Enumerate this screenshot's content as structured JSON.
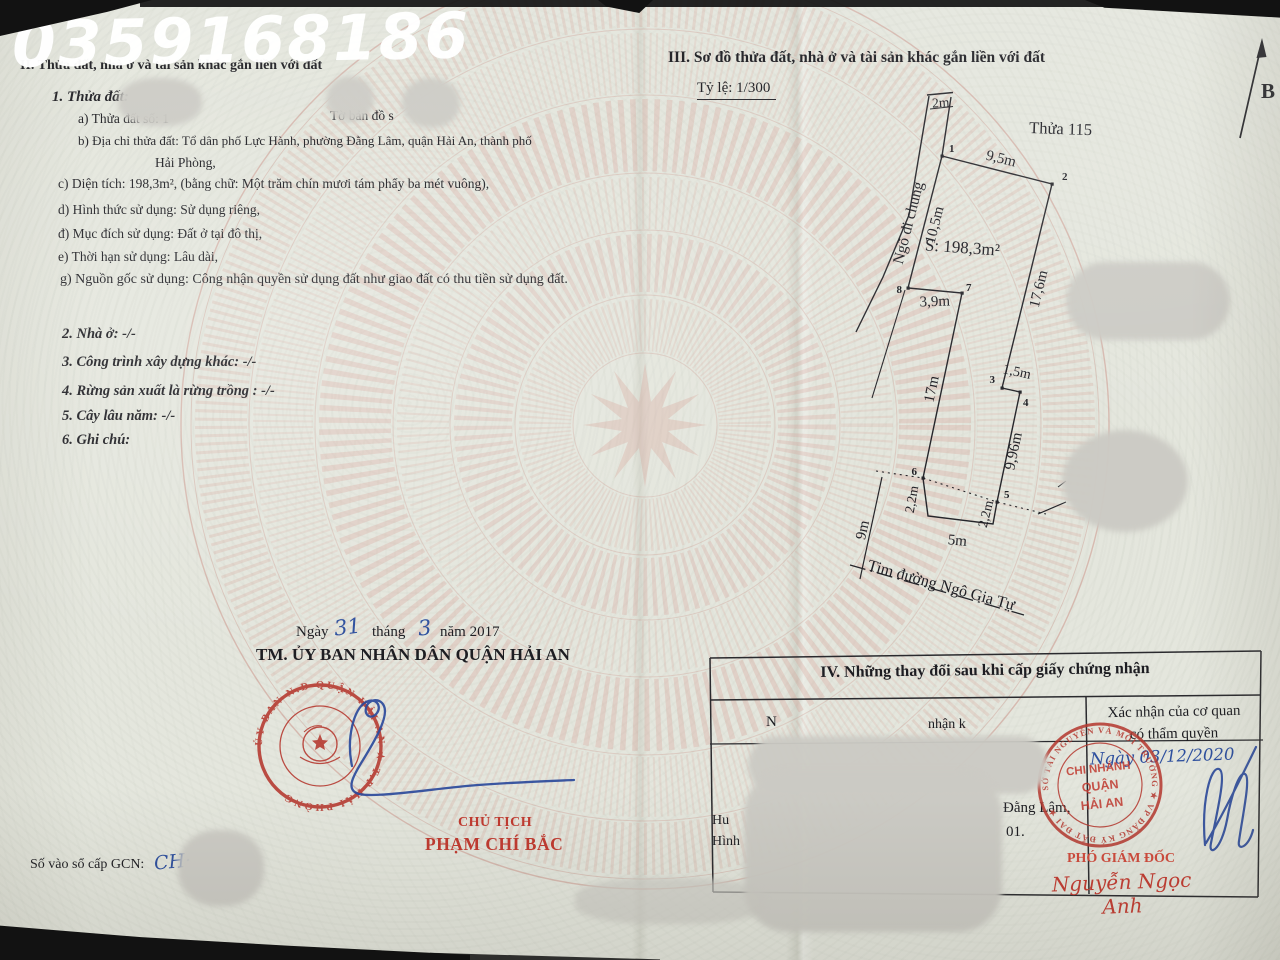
{
  "watermark": "0359168186",
  "left_page": {
    "section2_heading": "II. Thửa đất, nhà ở và tài sản khác gắn liền với đất",
    "block1": {
      "title": "1. Thửa đất:",
      "line_a": "a) Thửa đất số: 1",
      "line_a_right": "Tờ bản đồ s",
      "line_b": "b) Địa chỉ thửa đất:  Tổ dân phố Lực Hành, phường Đằng Lâm, quận Hải An, thành phố",
      "line_b2": "Hải Phòng,",
      "line_c": "c) Diện tích: 198,3m², (bằng chữ: Một trăm chín mươi tám phẩy ba mét vuông),",
      "line_d": "d) Hình thức sử dụng: Sử dụng riêng,",
      "line_dd": "đ) Mục đích sử dụng: Đất ở tại đô thị,",
      "line_e": "e) Thời hạn sử dụng: Lâu dài,",
      "line_g": "g) Nguồn gốc sử dụng: Công nhận quyền sử dụng đất như giao đất có thu tiền sử dụng đất."
    },
    "item2": "2. Nhà ở: -/-",
    "item3": "3. Công trình xây dựng khác: -/-",
    "item4": "4. Rừng sản xuất là rừng trồng : -/-",
    "item5": "5. Cây lâu năm: -/-",
    "item6": "6. Ghi chú:",
    "date": {
      "ngay": "Ngày",
      "day": "31",
      "thang": "tháng",
      "month": "3",
      "nam": "năm 2017"
    },
    "committee": "TM. ỦY BAN NHÂN DÂN QUẬN HẢI AN",
    "chairman_title": "CHỦ TỊCH",
    "chairman_name": "PHẠM CHÍ BẮC",
    "stamp_ring": "ỦY BAN N.D QUẬN HẢI AN ★ T.P HẢI PHÒNG",
    "gcn_label": "Số vào sổ cấp GCN:",
    "gcn_value": "CH·"
  },
  "right_page": {
    "section3_heading": "III. Sơ đồ thửa đất, nhà ở và tài sản khác gắn liền với đất",
    "scale": "Tỷ lệ: 1/300",
    "north": "B",
    "diagram": {
      "plot_label": "Thửa 115",
      "area": "S: 198,3m²",
      "lane": "Ngõ đi chung",
      "street": "Tim đường Ngô Gia Tự",
      "dims": {
        "top_width": "2m",
        "edge12": "9,5m",
        "edge81": "10,5m",
        "edge23": "17,6m",
        "edge34": "1,5m",
        "edge45": "9,96m",
        "edge67": "17m",
        "edge78": "3,9m",
        "left_drop": "2,2m",
        "bottom": "5m",
        "right_drop": "2,2m",
        "street_offset": "9m"
      },
      "vertices": [
        "1",
        "2",
        "3",
        "4",
        "5",
        "6",
        "7",
        "8"
      ]
    },
    "table": {
      "title": "IV. Những thay đổi sau khi cấp giấy chứng nhận",
      "col_header_1": "Xác nhận của cơ quan",
      "col_header_2": "có thẩm quyền",
      "frag_header_left": "N",
      "frag_header_mid": "nhận k",
      "frag_row1": "Hu",
      "frag_row2": "Hình",
      "frag_mid1": "Đằng Lâm,",
      "frag_mid2": "01.",
      "stamp_ring": "SỞ TÀI NGUYÊN VÀ MÔI TRƯỜNG ★ VP ĐĂNG KÝ ĐẤT ĐAI ★",
      "stamp_line1": "CHI NHÁNH",
      "stamp_line2": "QUẬN",
      "stamp_line3": "HẢI AN",
      "handwritten_date": "Ngày 03/12/2020",
      "deputy_title": "PHÓ GIÁM ĐỐC",
      "deputy_name": "Nguyễn Ngọc Anh"
    }
  }
}
